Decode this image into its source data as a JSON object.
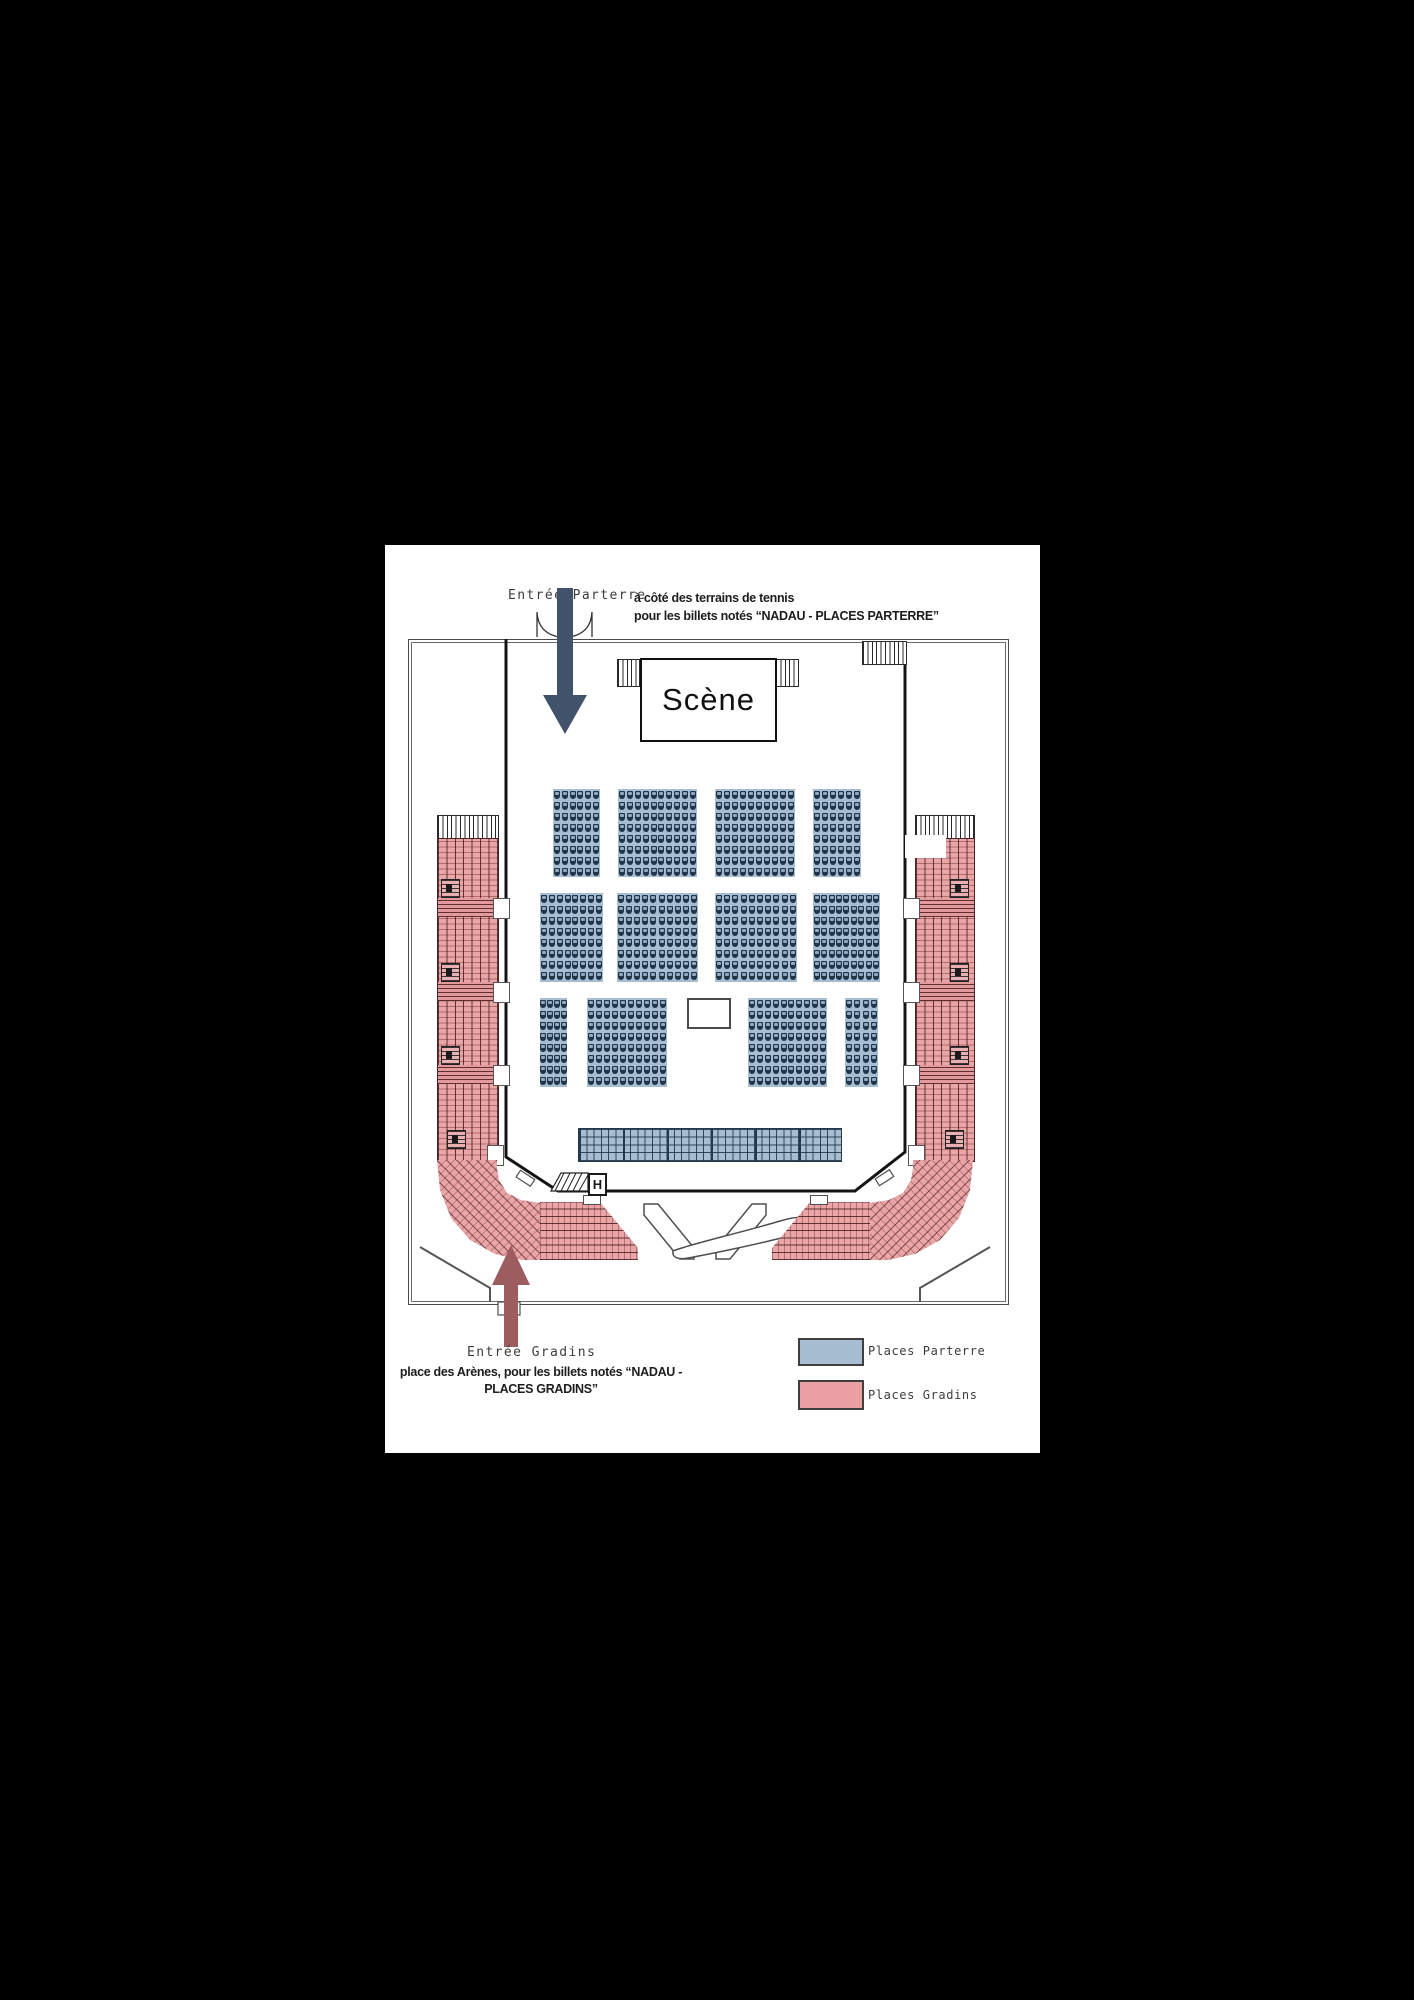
{
  "entrance_parterre": {
    "label": "Entrée Parterre",
    "desc_line1": "à côté des terrains de tennis",
    "desc_line2": "pour les billets notés “NADAU - PLACES PARTERRE”"
  },
  "entrance_gradins": {
    "label": "Entrée Gradins",
    "desc_line1": "place des Arènes, pour les billets notés “NADAU -",
    "desc_line2": "PLACES GRADINS”"
  },
  "stage": {
    "label": "Scène"
  },
  "booth_label": "",
  "legend": {
    "items": [
      {
        "label": "Places Parterre",
        "swatch": "#a6bcd1"
      },
      {
        "label": "Places Gradins",
        "swatch": "#eb9fa2"
      }
    ]
  },
  "colors": {
    "canvas_bg": "#000000",
    "page_bg": "#ffffff",
    "parterre_fill": "#a7bdd1",
    "parterre_seat": "#20354a",
    "gradins_fill": "#eaa5a7",
    "gradins_line": "#4d2424",
    "arrow_parterre": "#41536a",
    "arrow_gradins": "#9d5c60",
    "wall": "#4a4a4a"
  },
  "seating": {
    "parterre_blocks": [
      {
        "id": "r1-left",
        "x": 168,
        "y": 244,
        "w": 47,
        "h": 88,
        "cols": 6,
        "rows": 8
      },
      {
        "id": "r1-centerleft",
        "x": 233,
        "y": 244,
        "w": 79,
        "h": 88,
        "cols": 10,
        "rows": 8
      },
      {
        "id": "r1-centerright",
        "x": 330,
        "y": 244,
        "w": 80,
        "h": 88,
        "cols": 10,
        "rows": 8
      },
      {
        "id": "r1-right",
        "x": 428,
        "y": 244,
        "w": 48,
        "h": 88,
        "cols": 6,
        "rows": 8
      },
      {
        "id": "r2-left",
        "x": 155,
        "y": 348,
        "w": 63,
        "h": 89,
        "cols": 8,
        "rows": 8
      },
      {
        "id": "r2-centerleft",
        "x": 232,
        "y": 348,
        "w": 81,
        "h": 89,
        "cols": 10,
        "rows": 8
      },
      {
        "id": "r2-centerright",
        "x": 330,
        "y": 348,
        "w": 82,
        "h": 89,
        "cols": 10,
        "rows": 8
      },
      {
        "id": "r2-right",
        "x": 428,
        "y": 348,
        "w": 67,
        "h": 89,
        "cols": 9,
        "rows": 8
      },
      {
        "id": "r3-left",
        "x": 155,
        "y": 453,
        "w": 27,
        "h": 89,
        "cols": 4,
        "rows": 8
      },
      {
        "id": "r3-centerleft",
        "x": 202,
        "y": 453,
        "w": 80,
        "h": 89,
        "cols": 10,
        "rows": 8
      },
      {
        "id": "r3-centerright",
        "x": 363,
        "y": 453,
        "w": 79,
        "h": 89,
        "cols": 10,
        "rows": 8
      },
      {
        "id": "r3-right",
        "x": 460,
        "y": 453,
        "w": 33,
        "h": 89,
        "cols": 4,
        "rows": 8
      }
    ],
    "standing_block": {
      "x": 193,
      "y": 583,
      "w": 262,
      "h": 32,
      "rows": 4,
      "cols": 36
    },
    "booth": {
      "x": 302,
      "y": 453,
      "w": 40,
      "h": 27
    }
  }
}
